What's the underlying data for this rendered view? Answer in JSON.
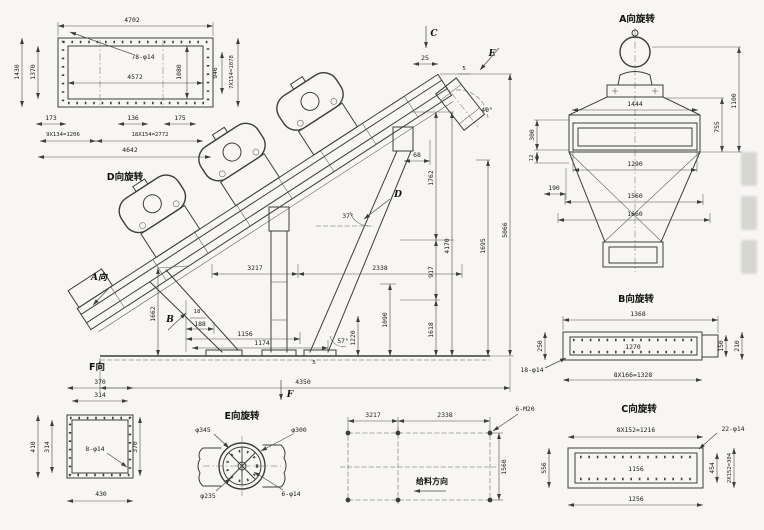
{
  "colors": {
    "line": "#3d3d3d",
    "paper": "#f7f6f2"
  },
  "d": {
    "title": "D向旋转",
    "top": "4702",
    "top_inner": "4572",
    "holes": "78-φ14",
    "left_outer": "1430",
    "left_inner": "1370",
    "right_inner": "1080",
    "right_margin": "946",
    "right_pitch": "7X154=1078",
    "b173": "173",
    "b136": "136",
    "b175": "175",
    "pitch_a": "9X134=1206",
    "pitch_b": "18X154=2772",
    "total": "4642"
  },
  "main": {
    "label_c": "C",
    "label_e": "E",
    "label_d": "D",
    "label_b": "B",
    "label_f": "F",
    "label_a": "A向",
    "d25": "25",
    "d5a": "5",
    "d5b": "5",
    "d68": "68",
    "d1762": "1762",
    "d917": "917",
    "d1618": "1618",
    "d4170": "4170",
    "d1695": "1695",
    "d5066": "5066",
    "d1090": "1090",
    "d1220": "1220",
    "d3217": "3217",
    "d2338": "2338",
    "d1662": "1662",
    "d18": "18",
    "d188": "188",
    "d1156": "1156",
    "d1174": "1174",
    "d4350": "4350",
    "a37": "37°",
    "a40": "40°",
    "a57": "57°"
  },
  "a": {
    "title": "A向旋转",
    "d1444": "1444",
    "d755": "755",
    "d1100": "1100",
    "d300": "300",
    "d12": "12",
    "d190": "190",
    "d1290": "1290",
    "d1560": "1560",
    "d1660": "1660"
  },
  "b": {
    "title": "B向旋转",
    "d1368": "1368",
    "d1270": "1270",
    "d250": "250",
    "d150": "150",
    "d210": "210",
    "holes": "18-φ14",
    "pitch": "8X166=1328"
  },
  "c": {
    "title": "C向旋转",
    "pitch": "8X152=1216",
    "holes": "22-φ14",
    "d556": "556",
    "d1156": "1156",
    "d1256": "1256",
    "d454": "454",
    "pitch2": "2X152=304"
  },
  "f": {
    "title": "F向",
    "top": "370",
    "top_inner": "314",
    "left": "410",
    "left_inner": "314",
    "right": "370",
    "bottom": "430",
    "holes": "8-φ14"
  },
  "e": {
    "title": "E向旋转",
    "d345": "φ345",
    "d300": "φ300",
    "d235": "φ235",
    "holes": "6-φ14"
  },
  "plan": {
    "d3217": "3217",
    "d2338": "2338",
    "d1560": "1560",
    "bolts": "6-M20",
    "feed": "给料方向"
  }
}
